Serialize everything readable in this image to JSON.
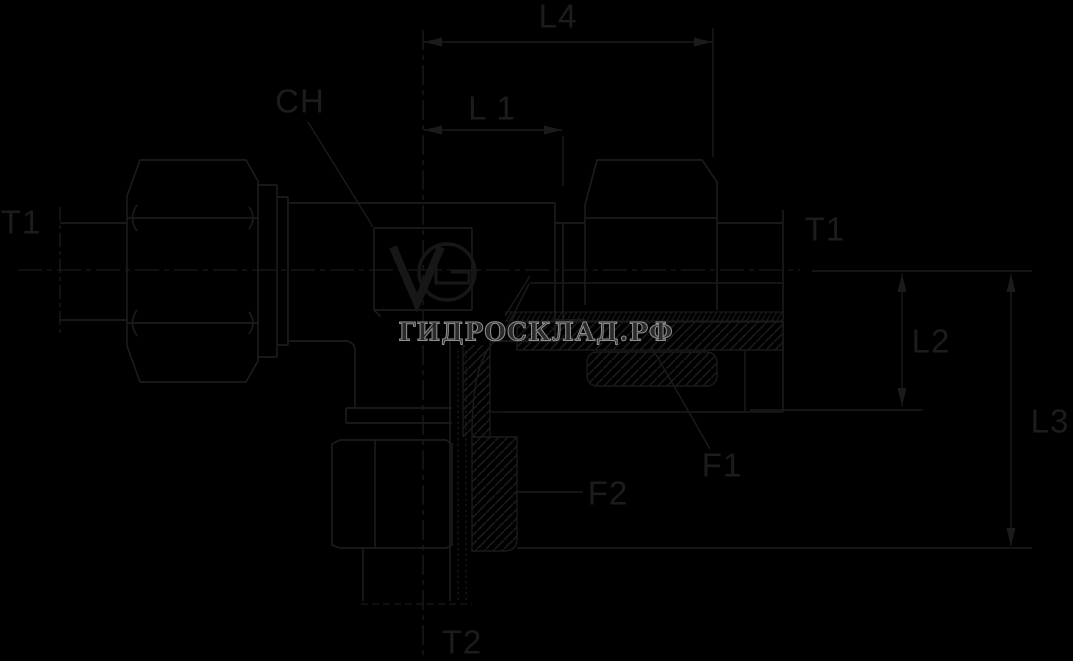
{
  "drawing": {
    "type": "technical-fitting-drawing",
    "colors": {
      "background": "#000000",
      "line": "#1b1b1b",
      "label": "#1c1c1c",
      "watermark_fill": "#2b2b2b",
      "watermark_stroke": "#8f8f8f"
    },
    "watermark": {
      "text": "ГИДРОСКЛАД.РФ"
    },
    "dimension_labels": {
      "l4": "L4",
      "l1": "L 1",
      "ch": "CH",
      "t1_left": "T1",
      "t1_right": "T1",
      "l2": "L2",
      "l3": "L3",
      "f1": "F1",
      "f2": "F2",
      "t2": "T2"
    }
  }
}
